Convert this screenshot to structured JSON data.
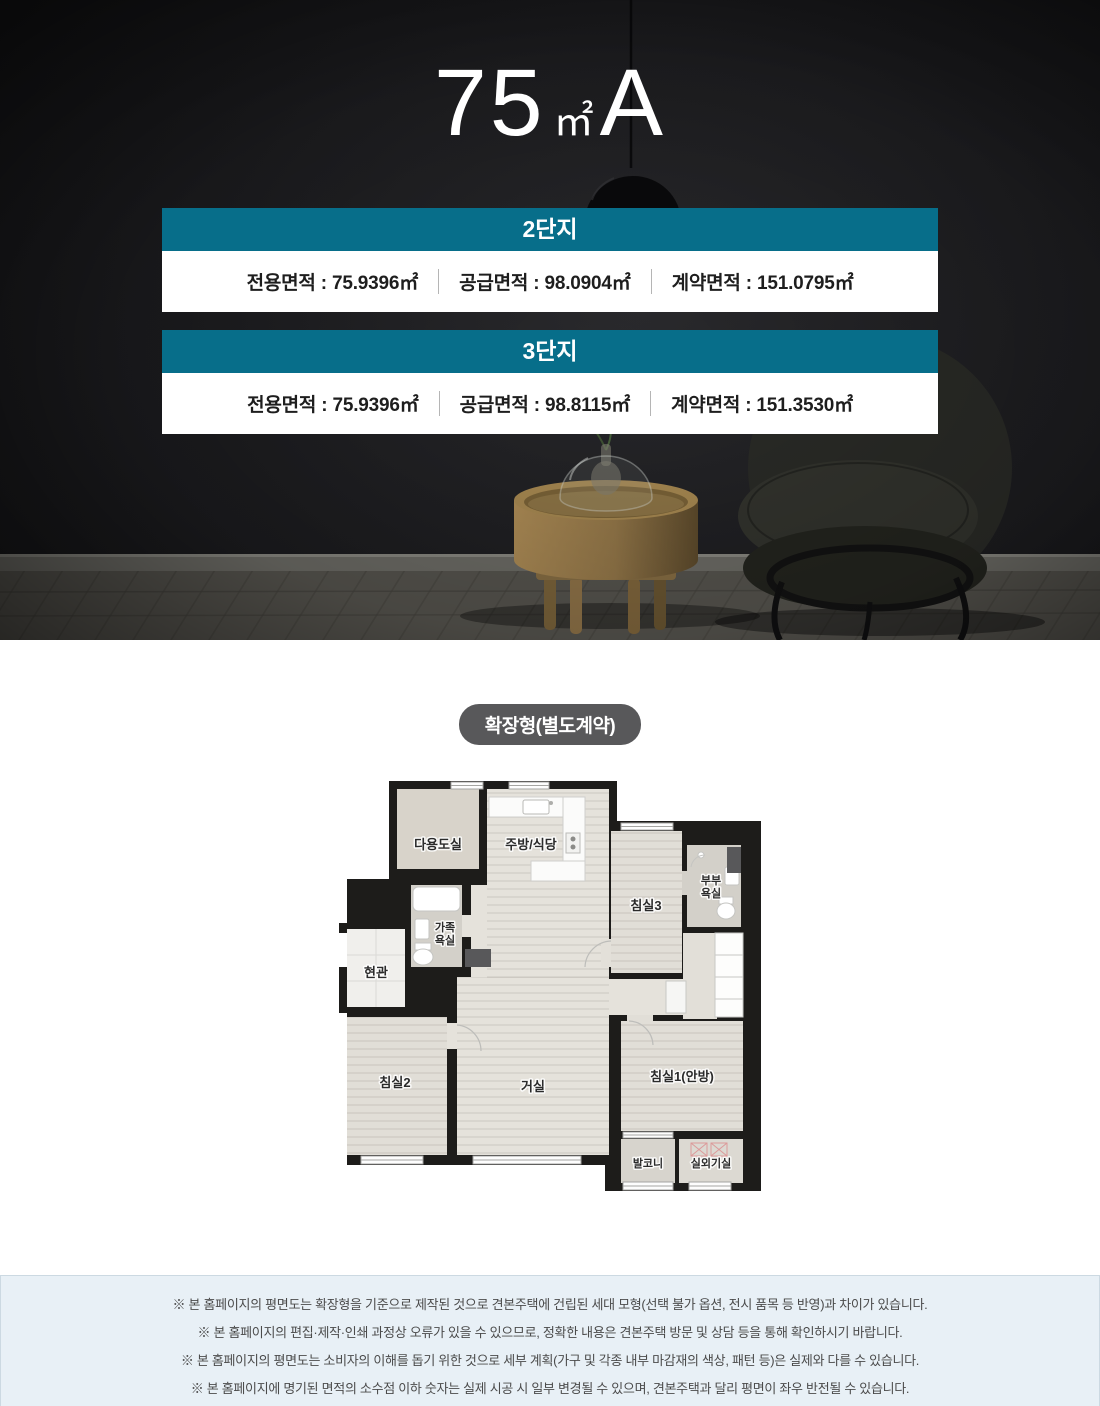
{
  "hero": {
    "title": {
      "number": "75",
      "unit": "㎡",
      "type": "A"
    },
    "complexes": [
      {
        "name": "2단지",
        "areas": [
          "전용면적 : 75.9396㎡",
          "공급면적 : 98.0904㎡",
          "계약면적 : 151.0795㎡"
        ]
      },
      {
        "name": "3단지",
        "areas": [
          "전용면적 : 75.9396㎡",
          "공급면적 : 98.8115㎡",
          "계약면적 : 151.3530㎡"
        ]
      }
    ]
  },
  "floorplan": {
    "badge": "확장형(별도계약)",
    "rooms": {
      "utility": "다용도실",
      "kitchen": "주방/식당",
      "bedroom3": "침실3",
      "master_bath_line1": "부부",
      "master_bath_line2": "욕실",
      "family_bath_line1": "가족",
      "family_bath_line2": "욕실",
      "entrance": "현관",
      "bedroom2": "침실2",
      "living": "거실",
      "bedroom1": "침실1(안방)",
      "balcony": "발코니",
      "ac_room": "실외기실"
    }
  },
  "notices": [
    "※ 본 홈페이지의 평면도는 확장형을 기준으로 제작된 것으로 견본주택에 건립된 세대 모형(선택 불가 옵션, 전시 품목 등 반영)과 차이가 있습니다.",
    "※ 본 홈페이지의 편집·제작·인쇄 과정상 오류가 있을 수 있으므로, 정확한 내용은 견본주택 방문 및 상담 등을 통해 확인하시기 바랍니다.",
    "※ 본 홈페이지의 평면도는 소비자의 이해를 돕기 위한 것으로 세부 계획(가구 및 각종 내부 마감재의 색상, 패턴 등)은 실제와 다를 수 있습니다.",
    "※ 본 홈페이지에 명기된 면적의 소수점 이하 숫자는 실제 시공 시 일부 변경될 수 있으며, 견본주택과 달리 평면이 좌우 반전될 수 있습니다."
  ],
  "colors": {
    "accent_teal": "#076e8a",
    "badge_gray": "#58585a",
    "notice_bg": "#e8f0f6",
    "hero_bg": "#1d1d20"
  }
}
